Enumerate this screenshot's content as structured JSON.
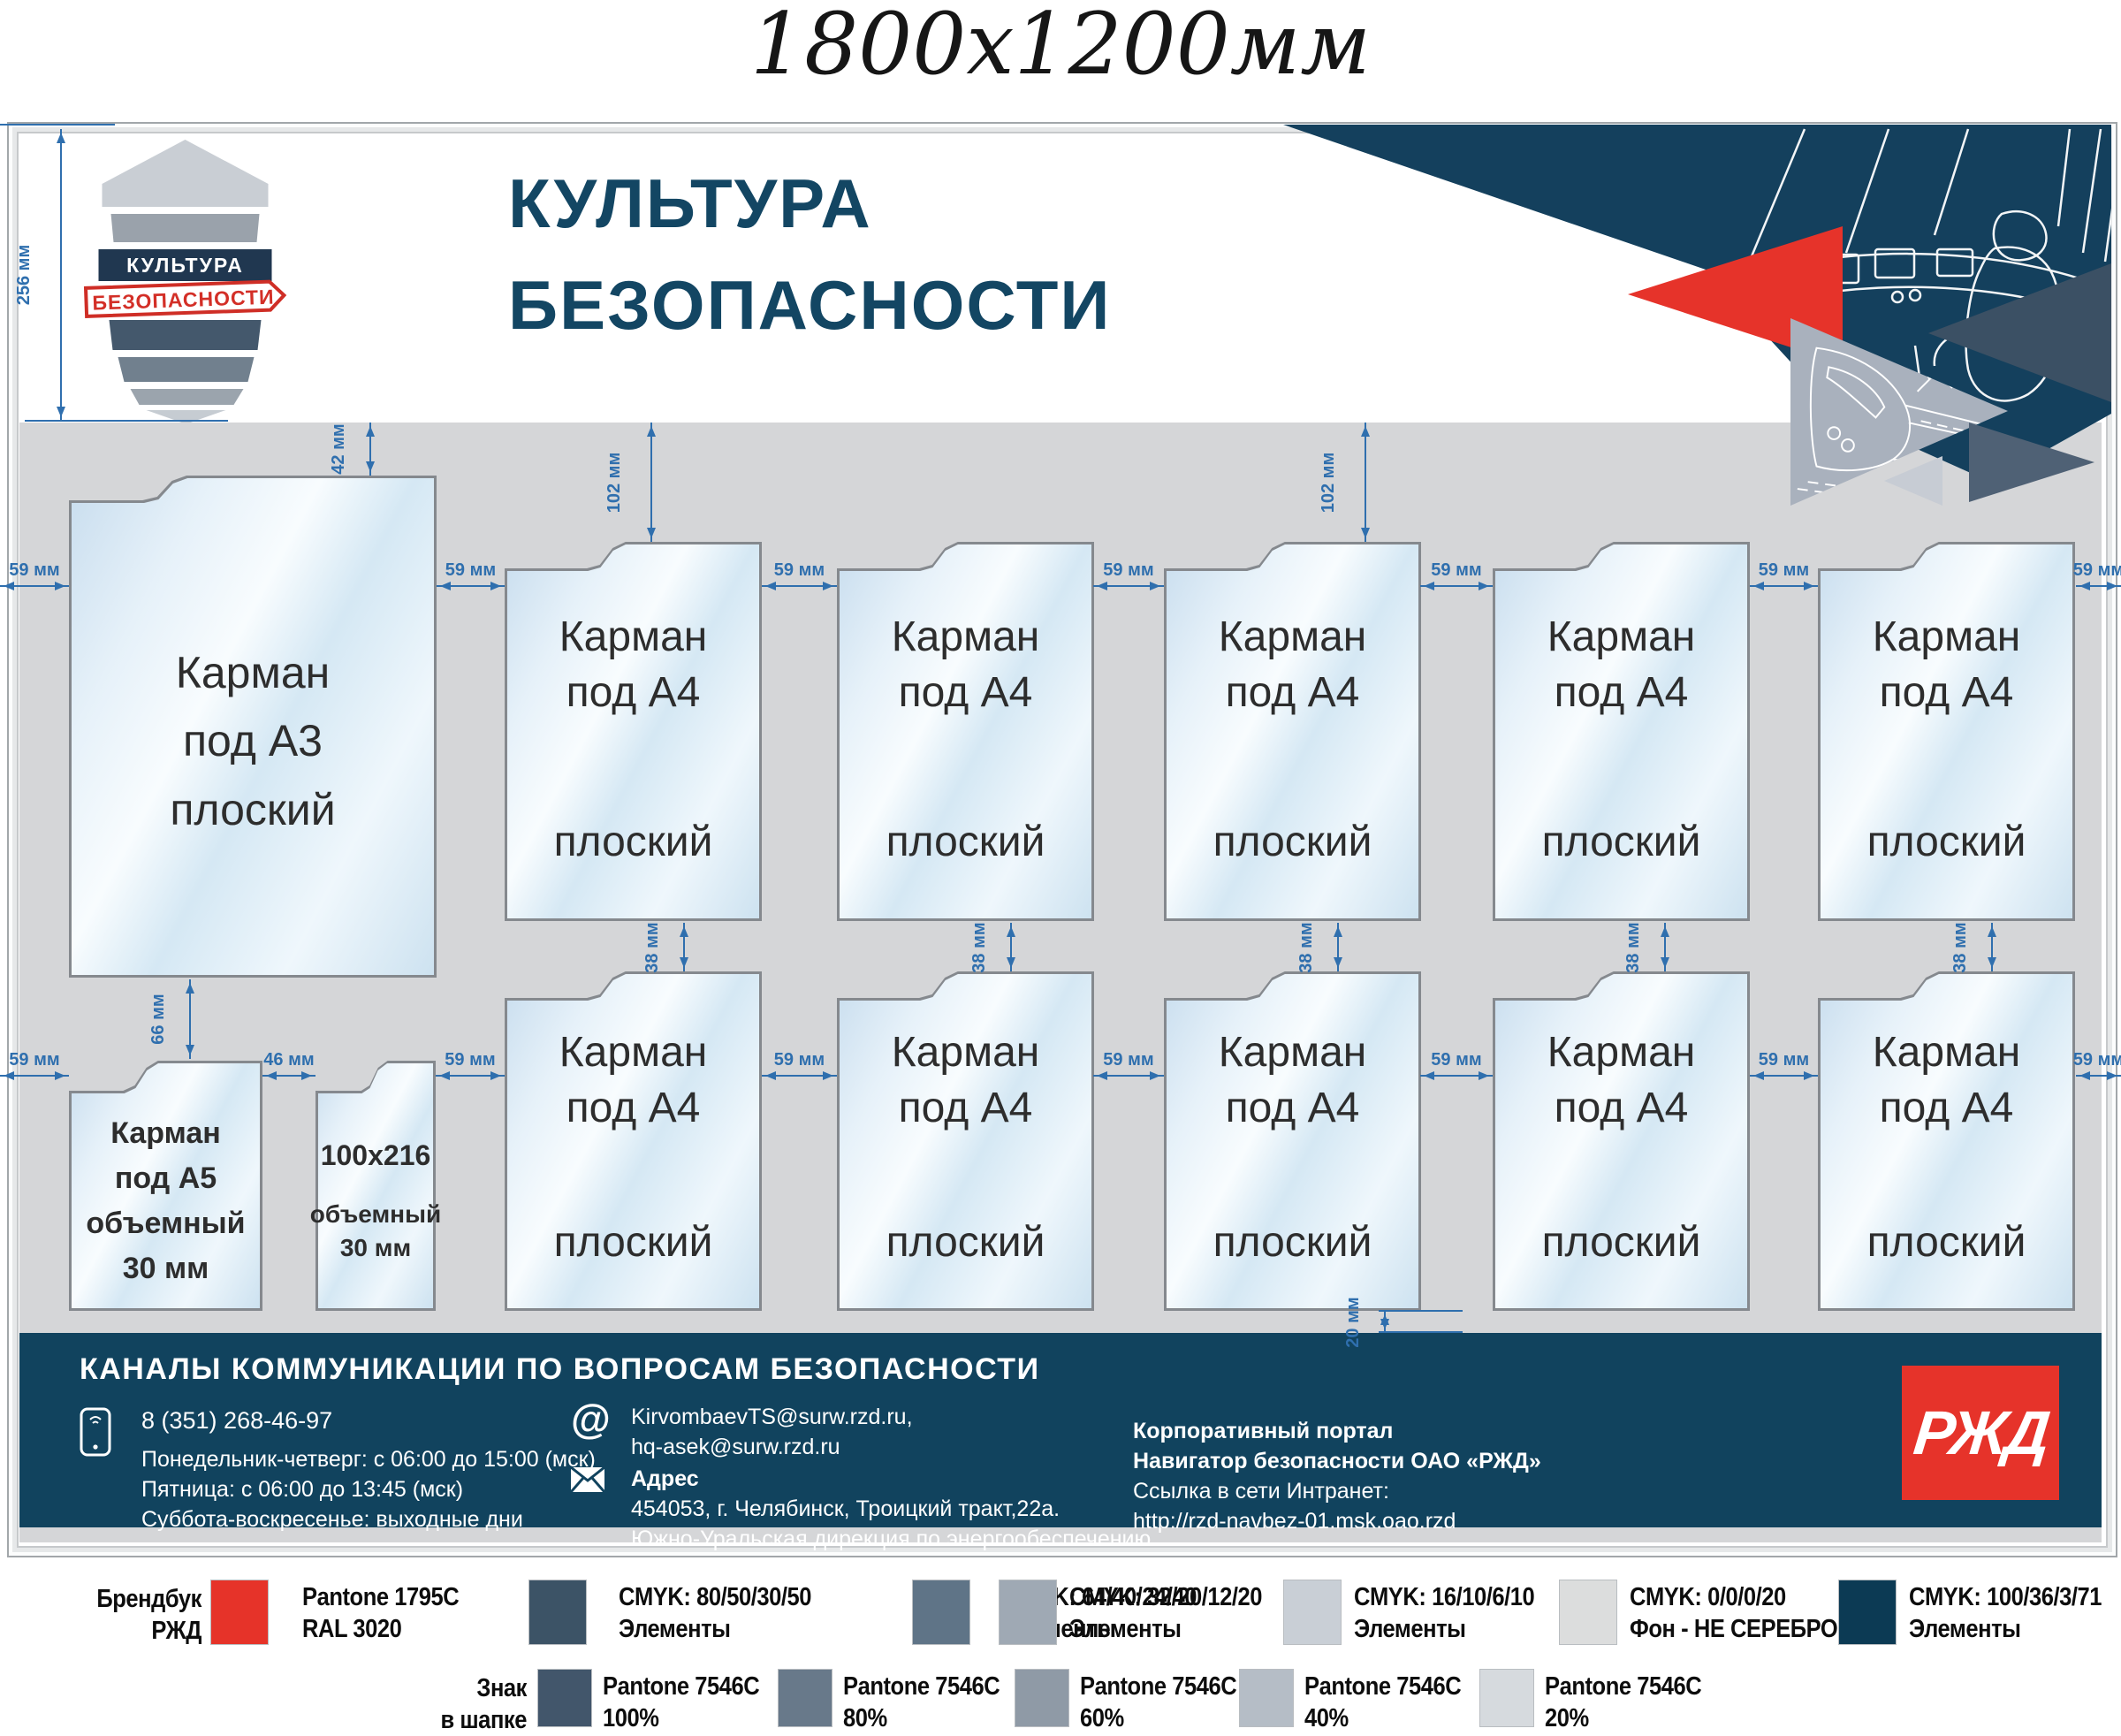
{
  "title": "1800х1200мм",
  "colors": {
    "brand_red": "#e6332a",
    "navy": "#11435e",
    "header_title": "#134663",
    "board_bg": "#d5d6d8",
    "dim_blue": "#2f6fae",
    "triangle_navy": "#14405d",
    "triangle_slate": "#3b5064",
    "triangle_gray": "#a9b1bd",
    "triangle_slate2": "#4f6175",
    "triangle_light": "#c7ccd4"
  },
  "logo": {
    "top": "КУЛЬТУРА",
    "banner": "БЕЗОПАСНОСТИ"
  },
  "header": {
    "line1": "КУЛЬТУРА",
    "line2": "БЕЗОПАСНОСТИ"
  },
  "dims": {
    "d256": "256 мм",
    "d42": "42 мм",
    "d102": "102 мм",
    "d59": "59 мм",
    "d38": "38 мм",
    "d66": "66 мм",
    "d46": "46 мм",
    "d20": "20 мм"
  },
  "pockets": {
    "a3": {
      "l1": "Карман",
      "l2": "под А3",
      "l3": "плоский"
    },
    "a4": {
      "l1": "Карман",
      "l2": "под А4",
      "l3": "плоский"
    },
    "a5": {
      "l1": "Карман",
      "l2": "под А5",
      "l3": "объемный",
      "l4": "30 мм"
    },
    "slim": {
      "l1": "100х216",
      "l2": "объемный",
      "l3": "30 мм"
    }
  },
  "footer": {
    "title": "КАНАЛЫ КОММУНИКАЦИИ ПО ВОПРОСАМ БЕЗОПАСНОСТИ",
    "phone": "8 (351) 268-46-97",
    "schedule1": "Понедельник-четверг: с 06:00 до 15:00 (мск)",
    "schedule2": "Пятница: с 06:00 до 13:45 (мск)",
    "schedule3": "Суббота-воскресенье: выходные дни",
    "email1": "KirvombaevTS@surw.rzd.ru,",
    "email2": "hq-asek@surw.rzd.ru",
    "at_sign": "@",
    "address_label": "Адрес",
    "address1": "454053, г. Челябинск, Троицкий тракт,22а.",
    "address2": "Южно-Уральская дирекция по энергообеспечению",
    "portal1": "Корпоративный портал",
    "portal2": "Навигатор безопасности ОАО «РЖД»",
    "portal3": "Ссылка в сети Интранет:",
    "portal4": "http://rzd-navbez-01.msk.oao.rzd",
    "logo_text": "РЖД"
  },
  "legend": {
    "row1": {
      "intro1": "Брендбук",
      "intro2": "РЖД",
      "items": [
        {
          "color": "#e63329",
          "line1": "Pantone 1795C",
          "line2": "RAL 3020"
        },
        {
          "color": "#3c5366",
          "line1": "CMYK: 80/50/30/50",
          "line2": "Элементы"
        },
        {
          "color": "#5f7487",
          "line1": "CMYK: 64/40/24/40",
          "line2": "Элементы"
        },
        {
          "color": "#9fa9b4",
          "line1": "CMYK: 32/20/12/20",
          "line2": "Элементы"
        },
        {
          "color": "#c9cfd6",
          "line1": "CMYK: 16/10/6/10",
          "line2": "Элементы"
        },
        {
          "color": "#dcdddd",
          "line1": "CMYK: 0/0/0/20",
          "line2": "Фон - НЕ СЕРЕБРО"
        },
        {
          "color": "#0c3a54",
          "line1": "CMYK: 100/36/3/71",
          "line2": "Элементы"
        }
      ]
    },
    "row2": {
      "intro1": "Знак",
      "intro2": "в шапке",
      "items": [
        {
          "color": "#42566b",
          "line1": "Pantone 7546C",
          "line2": "100%"
        },
        {
          "color": "#68798a",
          "line1": "Pantone 7546C",
          "line2": "80%"
        },
        {
          "color": "#8f9aa6",
          "line1": "Pantone 7546C",
          "line2": "60%"
        },
        {
          "color": "#b5bdc6",
          "line1": "Pantone 7546C",
          "line2": "40%"
        },
        {
          "color": "#d6dade",
          "line1": "Pantone 7546C",
          "line2": "20%"
        }
      ]
    }
  }
}
